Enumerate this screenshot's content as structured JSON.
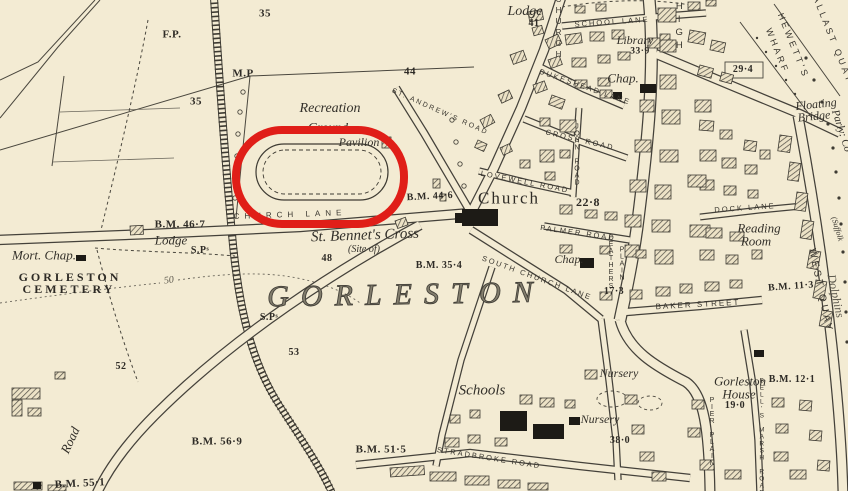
{
  "map": {
    "paper_color": "#f3ebd3",
    "ink_color": "#3e3b33",
    "annotation": {
      "shape": "rounded-rect",
      "x": 236,
      "y": 130,
      "width": 168,
      "height": 94,
      "corner_radius": 46,
      "stroke_width": 8,
      "color": "#e01e18"
    },
    "labels": [
      {
        "text": "F.P.",
        "x": 172,
        "y": 35,
        "size": 11,
        "rot": 0,
        "cls": "bm"
      },
      {
        "text": "35",
        "x": 265,
        "y": 14,
        "size": 11,
        "rot": 0,
        "cls": "bm"
      },
      {
        "text": "35",
        "x": 196,
        "y": 102,
        "size": 11,
        "rot": 0,
        "cls": "bm"
      },
      {
        "text": "M.P",
        "x": 243,
        "y": 74,
        "size": 11,
        "rot": 0,
        "cls": "bm"
      },
      {
        "text": "44",
        "x": 410,
        "y": 72,
        "size": 11,
        "rot": 0,
        "cls": "bm"
      },
      {
        "text": "Lodge",
        "x": 525,
        "y": 12,
        "size": 14,
        "rot": 0,
        "cls": "ital"
      },
      {
        "text": "41",
        "x": 534,
        "y": 24,
        "size": 10,
        "rot": 0,
        "cls": "bm"
      },
      {
        "text": "SCHOOL LANE",
        "x": 612,
        "y": 22,
        "size": 7.5,
        "rot": -4,
        "cls": "caps"
      },
      {
        "text": "Library",
        "x": 635,
        "y": 40,
        "size": 12,
        "rot": 0,
        "cls": "ital"
      },
      {
        "text": "33·9",
        "x": 640,
        "y": 52,
        "size": 9.5,
        "rot": 0,
        "cls": "bm"
      },
      {
        "text": "Chap.",
        "x": 623,
        "y": 78,
        "size": 13,
        "rot": 0,
        "cls": "ital"
      },
      {
        "text": "HIGH",
        "x": 679,
        "y": 27,
        "size": 9.5,
        "rot": 0,
        "cls": "vert"
      },
      {
        "text": "CHURCH",
        "x": 558,
        "y": 28,
        "size": 8,
        "rot": 0,
        "cls": "vert"
      },
      {
        "text": "29·4",
        "x": 743,
        "y": 70,
        "size": 10,
        "rot": 0,
        "cls": "bm"
      },
      {
        "text": "HEWETT'S",
        "x": 793,
        "y": 46,
        "size": 9,
        "rot": 68,
        "cls": "capsv"
      },
      {
        "text": "WHARF",
        "x": 777,
        "y": 51,
        "size": 9,
        "rot": 68,
        "cls": "capsv"
      },
      {
        "text": "BALLAST QUAY",
        "x": 831,
        "y": 36,
        "size": 9,
        "rot": 68,
        "cls": "capsv"
      },
      {
        "text": "Floating",
        "x": 816,
        "y": 104,
        "size": 12,
        "rot": -6,
        "cls": "ital"
      },
      {
        "text": "Bridge",
        "x": 814,
        "y": 116,
        "size": 12,
        "rot": -6,
        "cls": "ital"
      },
      {
        "text": "Parly: Co",
        "x": 841,
        "y": 131,
        "size": 11,
        "rot": 72,
        "cls": "ital"
      },
      {
        "text": "(Suffolk",
        "x": 837,
        "y": 229,
        "size": 8,
        "rot": 73,
        "cls": "ital"
      },
      {
        "text": "Dolphins",
        "x": 836,
        "y": 296,
        "size": 12,
        "rot": 78,
        "cls": "thin"
      },
      {
        "text": "WEST QUAY",
        "x": 820,
        "y": 291,
        "size": 10,
        "rot": 78,
        "cls": "capsv"
      },
      {
        "text": "DUKESHEAD LANE",
        "x": 585,
        "y": 87,
        "size": 7.5,
        "rot": 19,
        "cls": "caps"
      },
      {
        "text": "CROSS ROAD",
        "x": 580,
        "y": 140,
        "size": 7.5,
        "rot": 13,
        "cls": "caps"
      },
      {
        "text": "JOHN ROAD",
        "x": 577,
        "y": 155,
        "size": 7,
        "rot": 0,
        "cls": "vtight"
      },
      {
        "text": "LOVEWELL ROAD",
        "x": 525,
        "y": 182,
        "size": 7.5,
        "rot": 11,
        "cls": "caps"
      },
      {
        "text": "ST. ANDREW'S ROAD",
        "x": 440,
        "y": 112,
        "size": 7,
        "rot": 24,
        "cls": "caps"
      },
      {
        "text": "Recreation",
        "x": 330,
        "y": 109,
        "size": 14,
        "rot": 0,
        "cls": "ital"
      },
      {
        "text": "Ground",
        "x": 328,
        "y": 127,
        "size": 13,
        "rot": 0,
        "cls": "ital"
      },
      {
        "text": "Pavilion",
        "x": 359,
        "y": 142,
        "size": 12,
        "rot": 0,
        "cls": "ital"
      },
      {
        "text": "CHURCH LANE",
        "x": 290,
        "y": 215,
        "size": 8,
        "rot": -2,
        "cls": "capsw"
      },
      {
        "text": "B.M. 44·6",
        "x": 430,
        "y": 197,
        "size": 10,
        "rot": -3,
        "cls": "bm"
      },
      {
        "text": "Church",
        "x": 509,
        "y": 198,
        "size": 17,
        "rot": 0,
        "cls": "serifn"
      },
      {
        "text": "22·8",
        "x": 588,
        "y": 202,
        "size": 12,
        "rot": 0,
        "cls": "bm"
      },
      {
        "text": "PALMER ROAD",
        "x": 578,
        "y": 233,
        "size": 7.5,
        "rot": 8,
        "cls": "caps"
      },
      {
        "text": "St. Bennet's Cross",
        "x": 365,
        "y": 236,
        "size": 15,
        "rot": -2,
        "cls": "ital"
      },
      {
        "text": "(Site of)",
        "x": 364,
        "y": 250,
        "size": 10,
        "rot": 0,
        "cls": "ital"
      },
      {
        "text": "48",
        "x": 327,
        "y": 259,
        "size": 10,
        "rot": 0,
        "cls": "bm"
      },
      {
        "text": "B.M. 35·4",
        "x": 439,
        "y": 266,
        "size": 10,
        "rot": 0,
        "cls": "bm"
      },
      {
        "text": "SOUTH CHURCH LANE",
        "x": 537,
        "y": 278,
        "size": 7.5,
        "rot": 20,
        "cls": "caps"
      },
      {
        "text": "Chap.",
        "x": 569,
        "y": 259,
        "size": 12,
        "rot": 0,
        "cls": "ital"
      },
      {
        "text": "FEATHERS",
        "x": 611,
        "y": 262,
        "size": 7,
        "rot": 0,
        "cls": "vtight"
      },
      {
        "text": "PLAIN",
        "x": 622,
        "y": 264,
        "size": 7,
        "rot": 0,
        "cls": "vtight"
      },
      {
        "text": "17·3",
        "x": 614,
        "y": 292,
        "size": 10,
        "rot": 0,
        "cls": "bm"
      },
      {
        "text": "BAKER STREET",
        "x": 698,
        "y": 305,
        "size": 8,
        "rot": -3,
        "cls": "caps"
      },
      {
        "text": "B.M. 11·3",
        "x": 791,
        "y": 287,
        "size": 10,
        "rot": -4,
        "cls": "bm"
      },
      {
        "text": "DOCK LANE",
        "x": 745,
        "y": 208,
        "size": 7.5,
        "rot": -4,
        "cls": "caps"
      },
      {
        "text": "Reading",
        "x": 759,
        "y": 228,
        "size": 13,
        "rot": 0,
        "cls": "ital"
      },
      {
        "text": "Room",
        "x": 756,
        "y": 241,
        "size": 13,
        "rot": 0,
        "cls": "ital"
      },
      {
        "text": "GORLESTON",
        "x": 406,
        "y": 295,
        "size": 30,
        "rot": -1,
        "cls": "big"
      },
      {
        "text": "B.M. 46·7",
        "x": 180,
        "y": 225,
        "size": 11,
        "rot": 0,
        "cls": "bm"
      },
      {
        "text": "Lodge",
        "x": 171,
        "y": 240,
        "size": 13,
        "rot": 0,
        "cls": "ital"
      },
      {
        "text": "S.Pˢ",
        "x": 200,
        "y": 251,
        "size": 10,
        "rot": 0,
        "cls": "bm"
      },
      {
        "text": "S.Pˢ",
        "x": 269,
        "y": 318,
        "size": 10,
        "rot": 0,
        "cls": "bm"
      },
      {
        "text": "Mort. Chap.",
        "x": 44,
        "y": 255,
        "size": 13,
        "rot": 0,
        "cls": "ital"
      },
      {
        "text": "GORLESTON",
        "x": 70,
        "y": 277,
        "size": 12,
        "rot": 0,
        "cls": "cem"
      },
      {
        "text": "CEMETERY",
        "x": 69,
        "y": 289,
        "size": 12,
        "rot": 0,
        "cls": "cem"
      },
      {
        "text": "50",
        "x": 169,
        "y": 281,
        "size": 10,
        "rot": -8,
        "cls": "thin"
      },
      {
        "text": "52",
        "x": 121,
        "y": 367,
        "size": 10,
        "rot": 0,
        "cls": "bm"
      },
      {
        "text": "53",
        "x": 294,
        "y": 353,
        "size": 10,
        "rot": 0,
        "cls": "bm"
      },
      {
        "text": "Road",
        "x": 70,
        "y": 440,
        "size": 13,
        "rot": -65,
        "cls": "ital"
      },
      {
        "text": "B.M. 55·1",
        "x": 80,
        "y": 484,
        "size": 11,
        "rot": -3,
        "cls": "bm"
      },
      {
        "text": "B.M. 56·9",
        "x": 217,
        "y": 442,
        "size": 11,
        "rot": 0,
        "cls": "bm"
      },
      {
        "text": "Schools",
        "x": 482,
        "y": 391,
        "size": 15,
        "rot": 0,
        "cls": "ital"
      },
      {
        "text": "B.M. 51·5",
        "x": 381,
        "y": 450,
        "size": 11,
        "rot": 0,
        "cls": "bm"
      },
      {
        "text": "STRADBROKE ROAD",
        "x": 489,
        "y": 458,
        "size": 7.5,
        "rot": 9,
        "cls": "caps"
      },
      {
        "text": "Nursery",
        "x": 619,
        "y": 373,
        "size": 12,
        "rot": 0,
        "cls": "ital"
      },
      {
        "text": "Nursery",
        "x": 600,
        "y": 419,
        "size": 12,
        "rot": 0,
        "cls": "ital"
      },
      {
        "text": "38·0",
        "x": 620,
        "y": 441,
        "size": 10,
        "rot": 0,
        "cls": "bm"
      },
      {
        "text": "Gorleston",
        "x": 740,
        "y": 381,
        "size": 13,
        "rot": 0,
        "cls": "ital"
      },
      {
        "text": "B.M. 12·1",
        "x": 792,
        "y": 380,
        "size": 10,
        "rot": 0,
        "cls": "bm"
      },
      {
        "text": "House",
        "x": 739,
        "y": 394,
        "size": 13,
        "rot": 0,
        "cls": "ital"
      },
      {
        "text": "19·0",
        "x": 735,
        "y": 406,
        "size": 10,
        "rot": 0,
        "cls": "bm"
      },
      {
        "text": "PIER PLAIN",
        "x": 712,
        "y": 432,
        "size": 7,
        "rot": 0,
        "cls": "vtight"
      },
      {
        "text": "BELL'S MARSH ROAD",
        "x": 761,
        "y": 437,
        "size": 6.5,
        "rot": 0,
        "cls": "vtight"
      }
    ]
  }
}
